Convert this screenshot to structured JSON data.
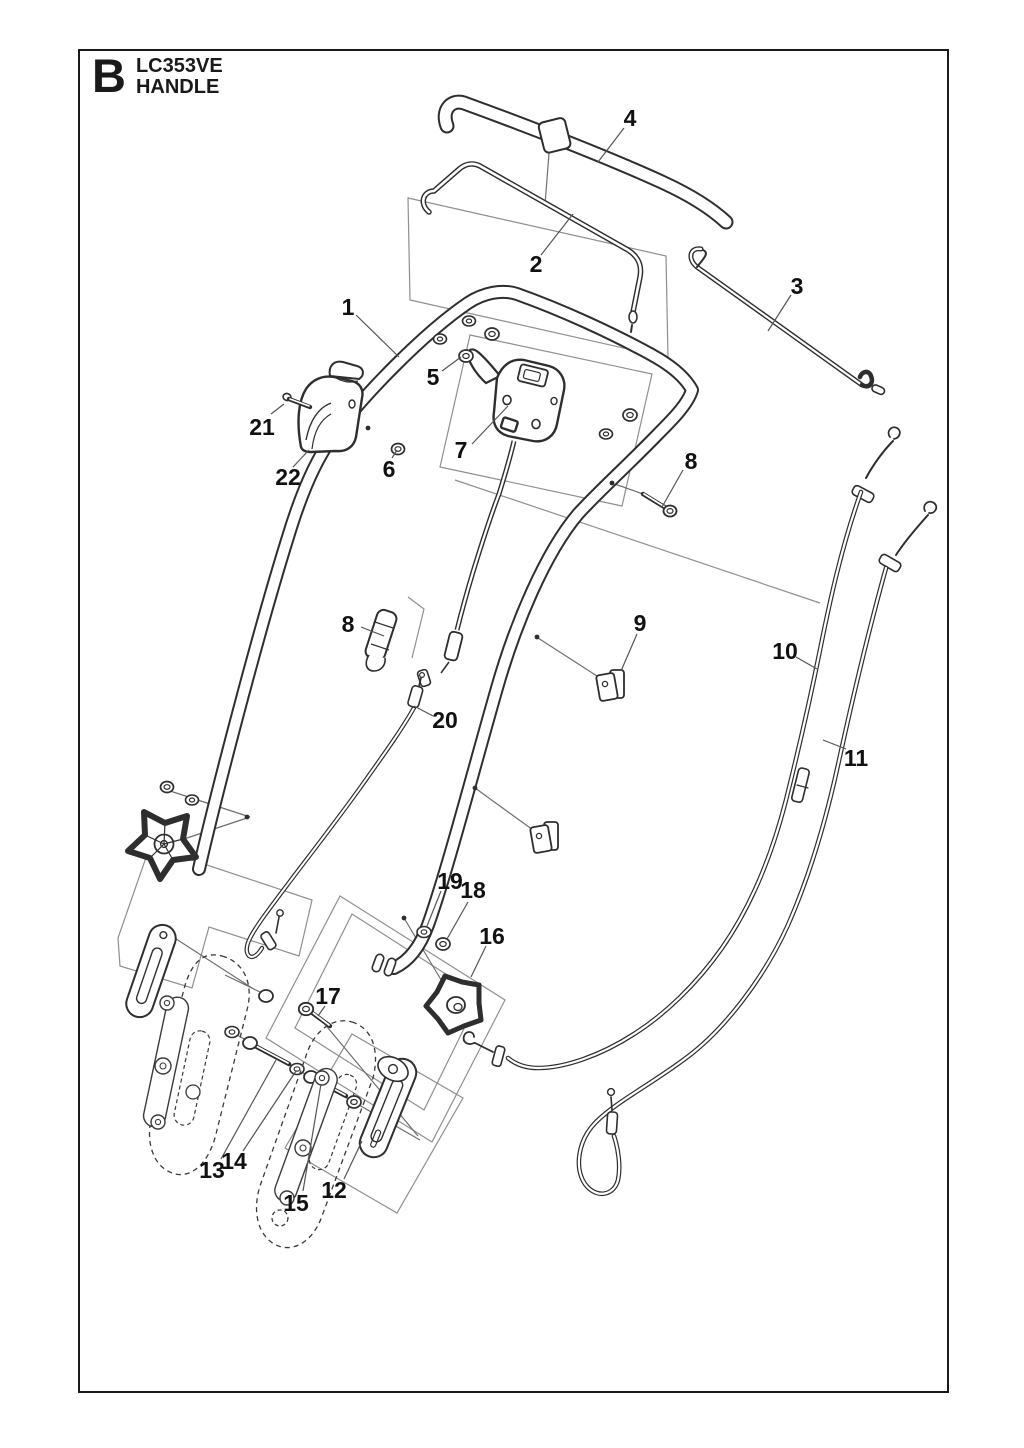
{
  "header": {
    "section_letter": "B",
    "model": "LC353VE",
    "subtitle": "HANDLE"
  },
  "canvas": {
    "width": 1024,
    "height": 1448
  },
  "colors": {
    "ink": "#1a1a1a",
    "outline": "#3a3a3a",
    "thin_line": "#707070",
    "panel_line": "#8f8f8f",
    "paper": "#ffffff"
  },
  "diagram": {
    "description": "Exploded parts view of mower handle assembly",
    "callouts": [
      {
        "label": "4",
        "x": 630,
        "y": 118,
        "leader": {
          "x1": 624,
          "y1": 128,
          "x2": 598,
          "y2": 162
        }
      },
      {
        "label": "2",
        "x": 536,
        "y": 264,
        "leader": {
          "x1": 541,
          "y1": 255,
          "x2": 573,
          "y2": 214
        }
      },
      {
        "label": "3",
        "x": 797,
        "y": 286,
        "leader": {
          "x1": 791,
          "y1": 295,
          "x2": 768,
          "y2": 331
        }
      },
      {
        "label": "1",
        "x": 348,
        "y": 307,
        "leader": {
          "x1": 356,
          "y1": 315,
          "x2": 399,
          "y2": 357
        }
      },
      {
        "label": "5",
        "x": 433,
        "y": 377,
        "leader": {
          "x1": 442,
          "y1": 371,
          "x2": 461,
          "y2": 357
        }
      },
      {
        "label": "21",
        "x": 262,
        "y": 427,
        "leader": {
          "x1": 271,
          "y1": 414,
          "x2": 284,
          "y2": 404
        }
      },
      {
        "label": "22",
        "x": 288,
        "y": 477,
        "leader": {
          "x1": 293,
          "y1": 467,
          "x2": 309,
          "y2": 450
        }
      },
      {
        "label": "6",
        "x": 389,
        "y": 469,
        "leader": {
          "x1": 392,
          "y1": 458,
          "x2": 397,
          "y2": 450
        }
      },
      {
        "label": "7",
        "x": 461,
        "y": 450,
        "leader": {
          "x1": 472,
          "y1": 444,
          "x2": 508,
          "y2": 406
        }
      },
      {
        "label": "8",
        "x": 691,
        "y": 461,
        "leader": {
          "x1": 683,
          "y1": 470,
          "x2": 662,
          "y2": 507
        }
      },
      {
        "label": "8",
        "x": 348,
        "y": 624,
        "leader": {
          "x1": 361,
          "y1": 627,
          "x2": 384,
          "y2": 636
        }
      },
      {
        "label": "9",
        "x": 640,
        "y": 623,
        "leader": {
          "x1": 637,
          "y1": 634,
          "x2": 621,
          "y2": 671
        }
      },
      {
        "label": "10",
        "x": 785,
        "y": 651,
        "leader": {
          "x1": 796,
          "y1": 657,
          "x2": 817,
          "y2": 669
        }
      },
      {
        "label": "11",
        "x": 856,
        "y": 758,
        "leader": {
          "x1": 846,
          "y1": 749,
          "x2": 823,
          "y2": 740
        }
      },
      {
        "label": "20",
        "x": 445,
        "y": 720,
        "leader": {
          "x1": 433,
          "y1": 716,
          "x2": 414,
          "y2": 706
        }
      },
      {
        "label": "19",
        "x": 450,
        "y": 881,
        "leader": {
          "x1": 441,
          "y1": 891,
          "x2": 427,
          "y2": 926
        }
      },
      {
        "label": "18",
        "x": 473,
        "y": 890,
        "leader": {
          "x1": 468,
          "y1": 902,
          "x2": 447,
          "y2": 939
        }
      },
      {
        "label": "16",
        "x": 492,
        "y": 936,
        "leader": {
          "x1": 486,
          "y1": 946,
          "x2": 471,
          "y2": 977
        }
      },
      {
        "label": "17",
        "x": 328,
        "y": 996,
        "leader": {
          "x1": 325,
          "y1": 1006,
          "x2": 318,
          "y2": 1016
        }
      },
      {
        "label": "13",
        "x": 212,
        "y": 1170,
        "leader": {
          "x1": 221,
          "y1": 1159,
          "x2": 276,
          "y2": 1060
        }
      },
      {
        "label": "14",
        "x": 234,
        "y": 1161,
        "leader": {
          "x1": 243,
          "y1": 1151,
          "x2": 296,
          "y2": 1071
        }
      },
      {
        "label": "15",
        "x": 296,
        "y": 1203,
        "leader": {
          "x1": 303,
          "y1": 1191,
          "x2": 321,
          "y2": 1084
        }
      },
      {
        "label": "12",
        "x": 334,
        "y": 1190,
        "leader": {
          "x1": 344,
          "y1": 1179,
          "x2": 362,
          "y2": 1141
        }
      }
    ]
  }
}
